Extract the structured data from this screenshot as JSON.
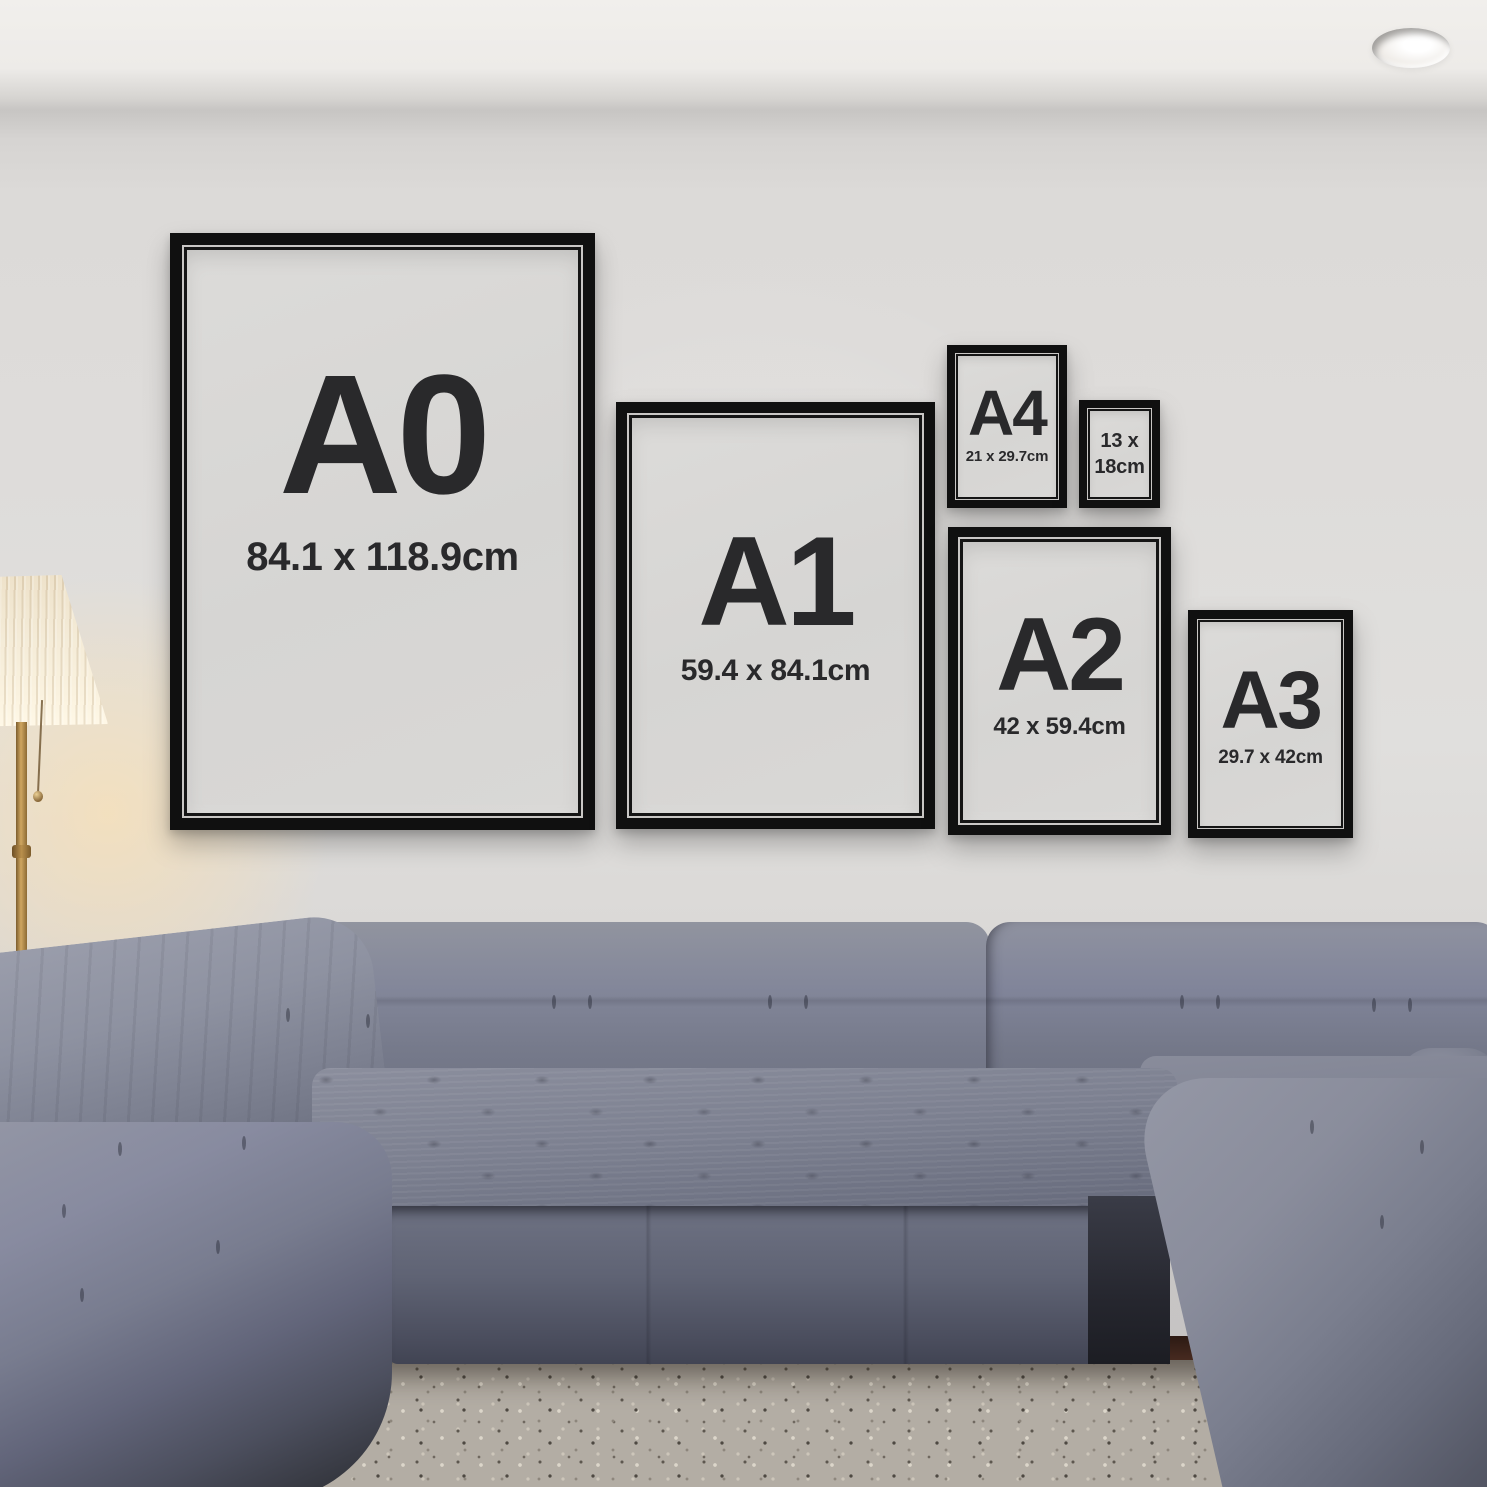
{
  "room": {
    "wall_color": "#dedcda",
    "ceiling_color": "#f1efec",
    "carpet_color": "#b3ada4",
    "wood_floor_color": "#3d2317",
    "sofa_color": "#787c8c",
    "frame_color": "#101010",
    "frame_mat_color": "#d8d7d5",
    "frame_text_color": "#29292b",
    "lamp_shade_color": "#f6eedb",
    "lamp_stem_color": "#b28e52",
    "lamp_glow_color": "#ffe1ad"
  },
  "frames": [
    {
      "id": "A0",
      "label": "A0",
      "dimensions": "84.1 x 118.9cm"
    },
    {
      "id": "A1",
      "label": "A1",
      "dimensions": "59.4 x 84.1cm"
    },
    {
      "id": "A4",
      "label": "A4",
      "dimensions": "21 x 29.7cm"
    },
    {
      "id": "13x18",
      "dimensions_line1": "13 x",
      "dimensions_line2": "18cm"
    },
    {
      "id": "A2",
      "label": "A2",
      "dimensions": "42 x 59.4cm"
    },
    {
      "id": "A3",
      "label": "A3",
      "dimensions": "29.7 x 42cm"
    }
  ]
}
